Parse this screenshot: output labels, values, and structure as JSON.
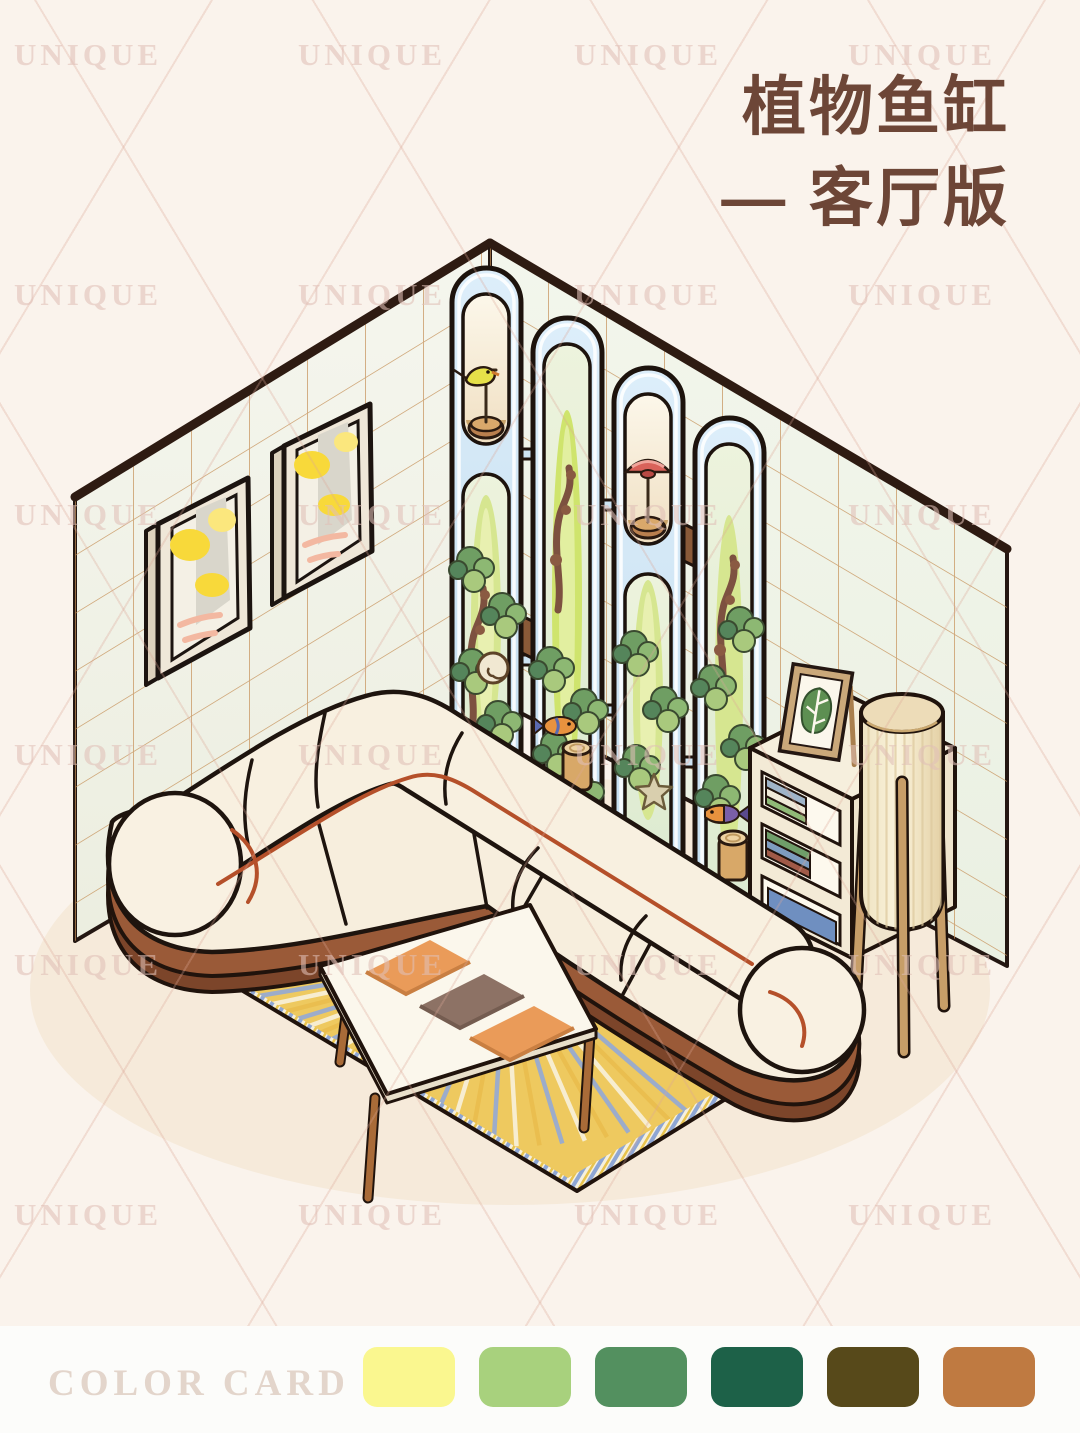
{
  "poster": {
    "title": {
      "line1": "植物鱼缸",
      "line2": "— 客厅版"
    },
    "title_color": "#6D4637",
    "background_color": "#FAF3EC",
    "watermark_text": "UNIQUE"
  },
  "color_card": {
    "label": "COLOR CARD",
    "swatches": [
      {
        "name": "pale-yellow",
        "hex": "#FAF78F"
      },
      {
        "name": "light-green",
        "hex": "#A8D17D"
      },
      {
        "name": "medium-green",
        "hex": "#53905F"
      },
      {
        "name": "dark-teal-green",
        "hex": "#1D6148"
      },
      {
        "name": "dark-olive",
        "hex": "#57491A"
      },
      {
        "name": "terracotta",
        "hex": "#BF7A41"
      }
    ]
  },
  "palette": {
    "wall_tile": "#F2F4EA",
    "tile_line": "#C58F56",
    "wall_trim": "#2E1B12",
    "glass_blue": "#CDE3F2",
    "sofa_cream": "#F7EEDD",
    "sofa_accent_red": "#B5502A",
    "wood_brown": "#9A5A38",
    "rug_yellow": "#EEC95F",
    "rug_stripe_colors": [
      "#93A9D6",
      "#F8F1DD",
      "#E9BD4E"
    ],
    "cushion_orange": "#EA9B59",
    "cushion_gray": "#8D7265",
    "lamp_shade": "#F6EDD2",
    "leaf_green": "#7FA968",
    "painting_yellow": "#F8D93A"
  },
  "illustration": {
    "alt": "Isometric living room: tiled corner walls, two framed autumn paintings, four arched glass plant-aquarium columns with birds and fish, cream sectional sofa, coffee table with cushions, striped yellow rug, bookshelf with monstera picture, and a pleated floor lamp."
  }
}
